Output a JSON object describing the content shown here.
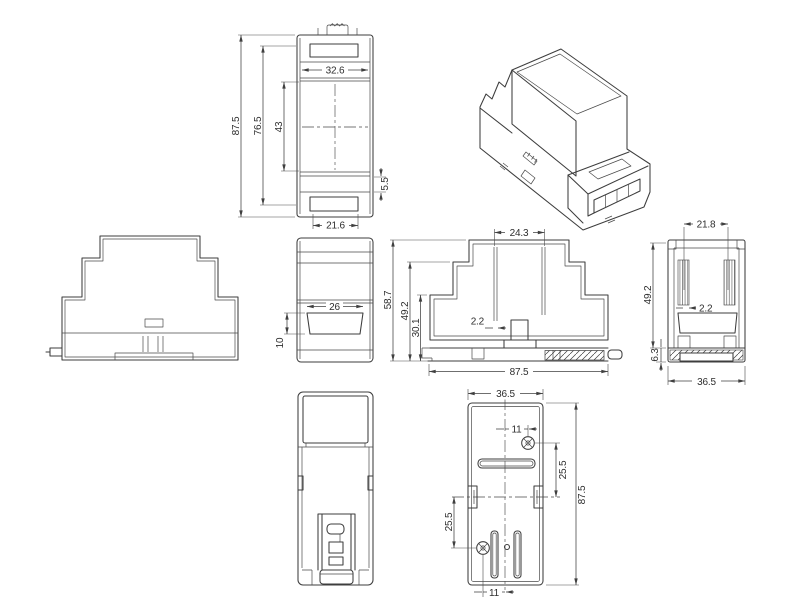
{
  "meta": {
    "description": "Multi-view dimensioned technical drawing of a DIN-rail plastic enclosure",
    "background_color": "#ffffff",
    "line_color": "#3d3d3d",
    "text_color": "#2e2e2e"
  },
  "drawing": {
    "views": {
      "top_view": {
        "dims": {
          "height_overall": "87.5",
          "height_inner": "76.5",
          "height_window": "43",
          "width_top": "32.6",
          "step": "5.5",
          "width_bottom_recess": "21.6"
        }
      },
      "side_view": {
        "dims": {
          "opening_width": "26",
          "opening_height": "10"
        }
      },
      "front_section_view": {
        "dims": {
          "pillar_spacing": "24.3",
          "height_overall": "58.7",
          "height_mid": "49.2",
          "height_body": "30.1",
          "wall_thickness": "2.2",
          "width_overall": "87.5"
        }
      },
      "side_section_view": {
        "dims": {
          "width_top": "21.8",
          "height_mid": "49.2",
          "wall_thickness": "2.2",
          "base_height": "6.3",
          "width_overall": "36.5"
        }
      },
      "bottom_view": {
        "dims": {
          "width_overall": "36.5",
          "screw_offset_top": "11",
          "screw_spacing_right": "25.5",
          "height_overall": "87.5",
          "screw_spacing_left": "25.5",
          "screw_offset_bottom": "11"
        }
      }
    }
  }
}
